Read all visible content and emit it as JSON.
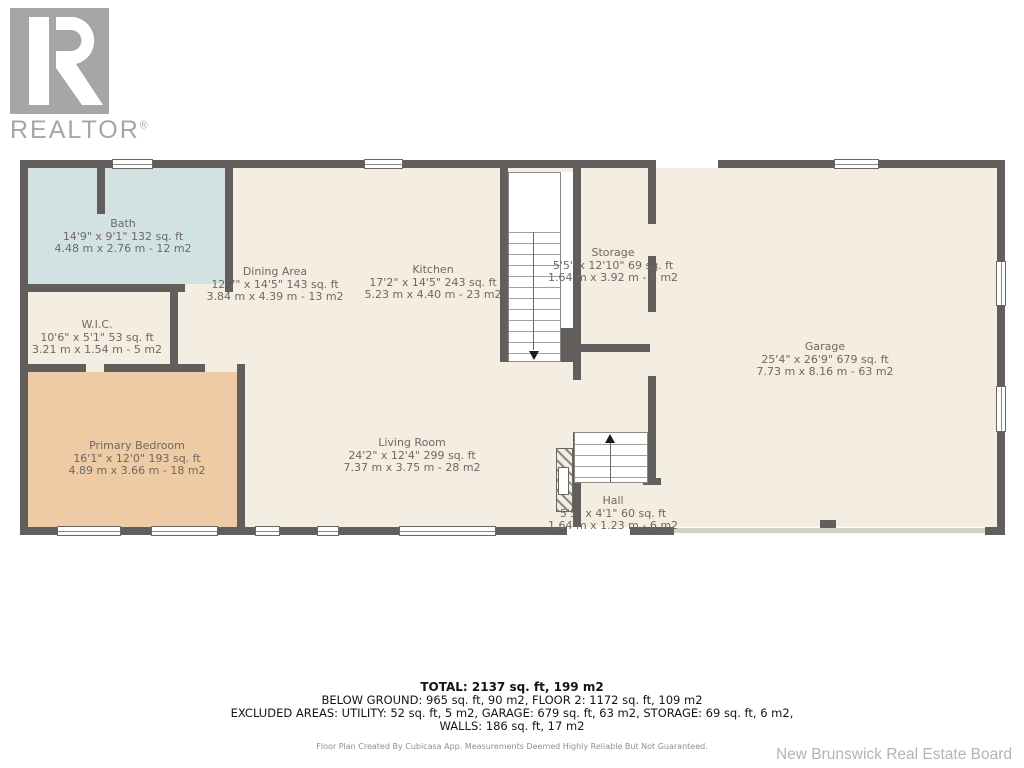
{
  "branding": {
    "logo_text": "REALTOR",
    "registered_mark": "®",
    "logo_color": "#a7a5a6"
  },
  "colors": {
    "wall": "#615e5b",
    "floor": "#f4ede2",
    "bath_fill": "#d2e2e3",
    "bedroom_fill": "#eecaa5",
    "label_text": "#6e6861",
    "attribution_gray": "#b5b4b3"
  },
  "floor_plan": {
    "rooms": [
      {
        "name": "Bath",
        "imperial": "14'9\" x 9'1\" 132 sq. ft",
        "metric": "4.48 m x 2.76 m - 12 m2"
      },
      {
        "name": "W.I.C.",
        "imperial": "10'6\" x 5'1\" 53 sq. ft",
        "metric": "3.21 m x 1.54 m - 5 m2"
      },
      {
        "name": "Dining Area",
        "imperial": "12'7\" x 14'5\" 143 sq. ft",
        "metric": "3.84 m x 4.39 m - 13 m2"
      },
      {
        "name": "Kitchen",
        "imperial": "17'2\" x 14'5\" 243 sq. ft",
        "metric": "5.23 m x 4.40 m - 23 m2"
      },
      {
        "name": "Storage",
        "imperial": "5'5\" x 12'10\" 69 sq. ft",
        "metric": "1.64 m x 3.92 m - 6 m2"
      },
      {
        "name": "Primary Bedroom",
        "imperial": "16'1\" x 12'0\" 193 sq. ft",
        "metric": "4.89 m x 3.66 m - 18 m2"
      },
      {
        "name": "Living Room",
        "imperial": "24'2\" x 12'4\" 299 sq. ft",
        "metric": "7.37 m x 3.75 m - 28 m2"
      },
      {
        "name": "Hall",
        "imperial": "5'5\" x 4'1\" 60 sq. ft",
        "metric": "1.64 m x 1.23 m - 6 m2"
      },
      {
        "name": "Garage",
        "imperial": "25'4\" x 26'9\" 679 sq. ft",
        "metric": "7.73 m x 8.16 m - 63 m2"
      }
    ]
  },
  "summary": {
    "total": "TOTAL: 2137 sq. ft, 199 m2",
    "line2": "BELOW GROUND: 965 sq. ft, 90 m2, FLOOR 2: 1172 sq. ft, 109 m2",
    "line3": "EXCLUDED AREAS: UTILITY: 52 sq. ft, 5 m2, GARAGE: 679 sq. ft, 63 m2, STORAGE: 69 sq. ft, 6 m2,",
    "line4": "WALLS: 186 sq. ft, 17 m2",
    "disclaimer": "Floor Plan Created By Cubicasa App. Measurements Deemed Highly Reliable But Not Guaranteed.",
    "attribution": "New Brunswick Real Estate Board"
  }
}
